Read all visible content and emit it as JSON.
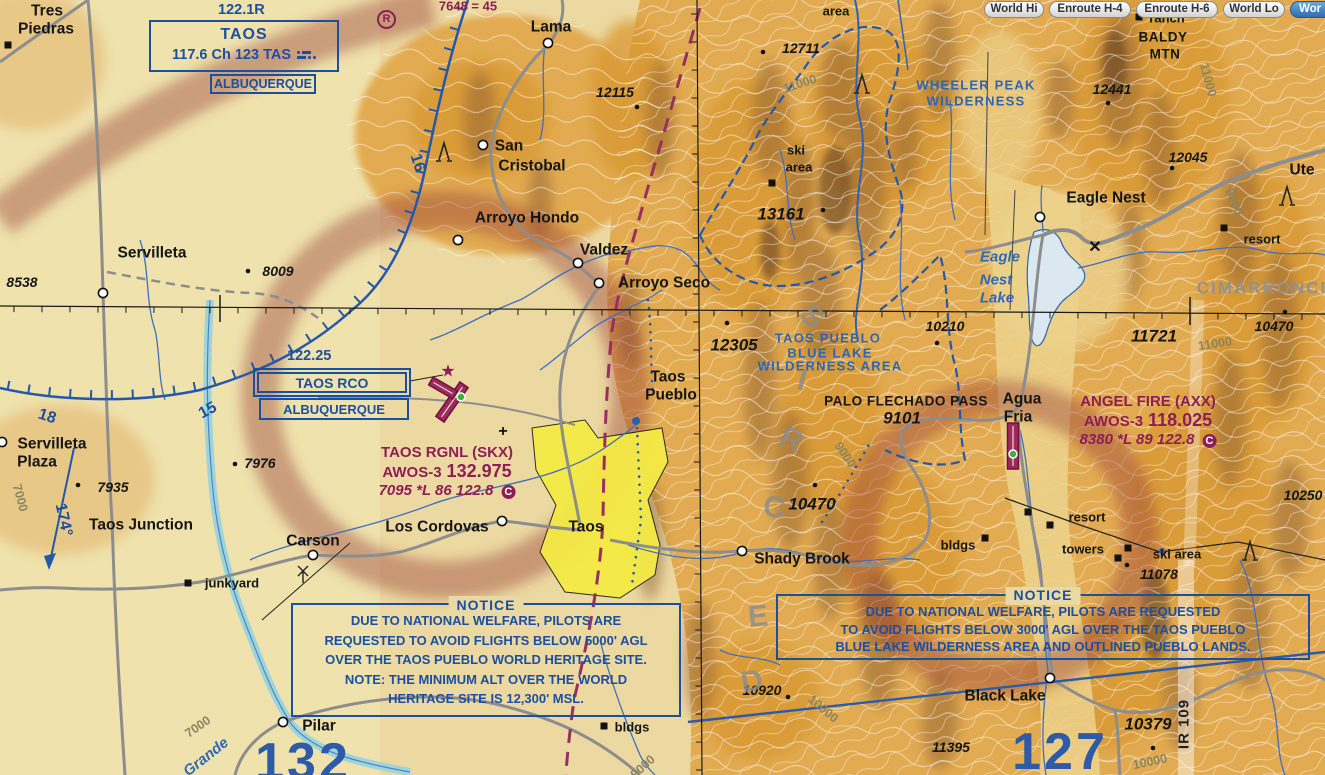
{
  "toolbar": {
    "buttons": [
      {
        "label": "World Hi",
        "active": false
      },
      {
        "label": "Enroute H-4",
        "active": false
      },
      {
        "label": "Enroute H-6",
        "active": false
      },
      {
        "label": "World Lo",
        "active": false
      },
      {
        "label": "Wor",
        "active": true
      }
    ]
  },
  "navaids": {
    "vor": {
      "freq": "122.1R",
      "name": "TAOS",
      "info": "117.6 Ch 123 TAS",
      "city": "ALBUQUERQUE"
    },
    "rco": {
      "freq": "122.25",
      "name": "TAOS RCO",
      "city": "ALBUQUERQUE"
    },
    "private_airport_symbol": "R"
  },
  "airports": {
    "taos_rgnl": {
      "name": "TAOS RGNL (SKX)",
      "awos": "AWOS-3",
      "freq": "132.975",
      "data": "7095 *L 86 122.8",
      "ctaf": "C"
    },
    "angel_fire": {
      "name": "ANGEL FIRE (AXX)",
      "awos": "AWOS-3",
      "freq": "118.025",
      "data": "8380 *L 89 122.8",
      "ctaf": "C"
    }
  },
  "notices": {
    "left": {
      "title": "NOTICE",
      "lines": [
        "DUE TO NATIONAL WELFARE, PILOTS ARE",
        "REQUESTED TO AVOID FLIGHTS BELOW 5000' AGL",
        "OVER THE TAOS PUEBLO WORLD HERITAGE SITE.",
        "NOTE: THE MINIMUM ALT OVER THE WORLD",
        "HERITAGE SITE IS 12,300' MSL."
      ]
    },
    "right": {
      "title": "NOTICE",
      "lines": [
        "DUE TO NATIONAL WELFARE, PILOTS ARE REQUESTED",
        "TO AVOID FLIGHTS BELOW 3000' AGL OVER THE TAOS PUEBLO",
        "BLUE LAKE WILDERNESS AREA AND OUTLINED PUEBLO LANDS."
      ]
    }
  },
  "colors": {
    "aero_blue": "#1d4fa0",
    "aero_magenta": "#8d1e55",
    "terrain_tan": "#ecd9a2",
    "terrain_orange": "#e2ab51",
    "city_yellow": "#f4ea45",
    "road_gray": "#8d8d8d",
    "water_blue": "#3f6fc0",
    "active_button_blue": "#2f6cb3"
  },
  "map": {
    "labels": [
      {
        "t": "Tres",
        "x": 47,
        "y": 11,
        "c": "town"
      },
      {
        "t": "Piedras",
        "x": 46,
        "y": 29,
        "c": "town"
      },
      {
        "t": "Lama",
        "x": 551,
        "y": 27,
        "c": "town"
      },
      {
        "t": "San",
        "x": 509,
        "y": 146,
        "c": "town"
      },
      {
        "t": "Cristobal",
        "x": 532,
        "y": 166,
        "c": "town"
      },
      {
        "t": "Arroyo Hondo",
        "x": 527,
        "y": 218,
        "c": "town"
      },
      {
        "t": "Valdez",
        "x": 604,
        "y": 250,
        "c": "town"
      },
      {
        "t": "Arroyo Seco",
        "x": 664,
        "y": 283,
        "c": "town"
      },
      {
        "t": "Servilleta",
        "x": 152,
        "y": 253,
        "c": "town"
      },
      {
        "t": "Servilleta",
        "x": 52,
        "y": 444,
        "c": "town"
      },
      {
        "t": "Plaza",
        "x": 37,
        "y": 462,
        "c": "town"
      },
      {
        "t": "Taos Junction",
        "x": 141,
        "y": 525,
        "c": "town"
      },
      {
        "t": "Carson",
        "x": 313,
        "y": 541,
        "c": "town"
      },
      {
        "t": "Los Cordovas",
        "x": 437,
        "y": 527,
        "c": "town"
      },
      {
        "t": "Taos",
        "x": 586,
        "y": 527,
        "c": "town"
      },
      {
        "t": "Shady Brook",
        "x": 802,
        "y": 559,
        "c": "town"
      },
      {
        "t": "Eagle Nest",
        "x": 1106,
        "y": 198,
        "c": "town"
      },
      {
        "t": "Black Lake",
        "x": 1005,
        "y": 696,
        "c": "town"
      },
      {
        "t": "Pilar",
        "x": 319,
        "y": 726,
        "c": "town"
      },
      {
        "t": "Agua",
        "x": 1022,
        "y": 399,
        "c": "town"
      },
      {
        "t": "Fria",
        "x": 1018,
        "y": 417,
        "c": "town"
      },
      {
        "t": "Taos",
        "x": 668,
        "y": 377,
        "c": "town"
      },
      {
        "t": "Pueblo",
        "x": 671,
        "y": 395,
        "c": "town"
      },
      {
        "t": "Ute",
        "x": 1302,
        "y": 170,
        "c": "town"
      },
      {
        "t": "ranch",
        "x": 1167,
        "y": 18,
        "c": "town-sm"
      },
      {
        "t": "junkyard",
        "x": 232,
        "y": 583,
        "c": "town-sm"
      },
      {
        "t": "bldgs",
        "x": 632,
        "y": 727,
        "c": "town-sm"
      },
      {
        "t": "bldgs",
        "x": 958,
        "y": 545,
        "c": "town-sm"
      },
      {
        "t": "resort",
        "x": 1087,
        "y": 517,
        "c": "town-sm"
      },
      {
        "t": "towers",
        "x": 1083,
        "y": 549,
        "c": "town-sm"
      },
      {
        "t": "ski area",
        "x": 1177,
        "y": 554,
        "c": "town-sm"
      },
      {
        "t": "resort",
        "x": 1262,
        "y": 239,
        "c": "town-sm"
      },
      {
        "t": "ski",
        "x": 796,
        "y": 150,
        "c": "town-sm"
      },
      {
        "t": "area",
        "x": 799,
        "y": 167,
        "c": "town-sm"
      },
      {
        "t": "area",
        "x": 836,
        "y": 11,
        "c": "town-sm"
      },
      {
        "t": "BALDY",
        "x": 1163,
        "y": 37,
        "c": "town-caps"
      },
      {
        "t": "MTN",
        "x": 1165,
        "y": 54,
        "c": "town-caps"
      },
      {
        "t": "PALO FLECHADO PASS",
        "x": 906,
        "y": 401,
        "c": "town-caps"
      },
      {
        "t": "8538",
        "x": 22,
        "y": 282,
        "c": "elev"
      },
      {
        "t": "8009",
        "x": 278,
        "y": 271,
        "c": "elev"
      },
      {
        "t": "7976",
        "x": 260,
        "y": 463,
        "c": "elev"
      },
      {
        "t": "7935",
        "x": 113,
        "y": 487,
        "c": "elev"
      },
      {
        "t": "12115",
        "x": 615,
        "y": 92,
        "c": "elev"
      },
      {
        "t": "12711",
        "x": 801,
        "y": 48,
        "c": "elev"
      },
      {
        "t": "12441",
        "x": 1112,
        "y": 89,
        "c": "elev"
      },
      {
        "t": "12045",
        "x": 1188,
        "y": 157,
        "c": "elev"
      },
      {
        "t": "13161",
        "x": 781,
        "y": 214,
        "c": "elev-lg"
      },
      {
        "t": "12305",
        "x": 734,
        "y": 345,
        "c": "elev-lg"
      },
      {
        "t": "10210",
        "x": 945,
        "y": 326,
        "c": "elev"
      },
      {
        "t": "11721",
        "x": 1154,
        "y": 336,
        "c": "elev-lg"
      },
      {
        "t": "10470",
        "x": 1274,
        "y": 326,
        "c": "elev"
      },
      {
        "t": "10470",
        "x": 812,
        "y": 504,
        "c": "elev-lg"
      },
      {
        "t": "9101",
        "x": 902,
        "y": 418,
        "c": "elev-lg"
      },
      {
        "t": "11078",
        "x": 1159,
        "y": 574,
        "c": "elev"
      },
      {
        "t": "10250",
        "x": 1303,
        "y": 495,
        "c": "elev"
      },
      {
        "t": "10920",
        "x": 762,
        "y": 690,
        "c": "elev"
      },
      {
        "t": "11395",
        "x": 951,
        "y": 747,
        "c": "elev"
      },
      {
        "t": "10379",
        "x": 1148,
        "y": 724,
        "c": "elev-lg"
      },
      {
        "t": "WHEELER PEAK",
        "x": 976,
        "y": 85,
        "c": "wild"
      },
      {
        "t": "WILDERNESS",
        "x": 976,
        "y": 101,
        "c": "wild"
      },
      {
        "t": "TAOS PUEBLO",
        "x": 828,
        "y": 338,
        "c": "wild"
      },
      {
        "t": "BLUE LAKE",
        "x": 830,
        "y": 353,
        "c": "wild"
      },
      {
        "t": "WILDERNESS AREA",
        "x": 830,
        "y": 366,
        "c": "wild"
      },
      {
        "t": "Eagle",
        "x": 1000,
        "y": 257,
        "c": "blue-it"
      },
      {
        "t": "Nest",
        "x": 996,
        "y": 280,
        "c": "blue-it"
      },
      {
        "t": "Lake",
        "x": 997,
        "y": 298,
        "c": "blue-it"
      },
      {
        "t": "CIMARRONCI",
        "x": 1262,
        "y": 288,
        "c": "gray-caps"
      },
      {
        "t": "Grande",
        "x": 206,
        "y": 757,
        "c": "river",
        "r": -38
      },
      {
        "t": "11000",
        "x": 800,
        "y": 84,
        "c": "contour",
        "r": -18
      },
      {
        "t": "11000",
        "x": 1208,
        "y": 80,
        "c": "contour",
        "r": 75
      },
      {
        "t": "11000",
        "x": 1215,
        "y": 344,
        "c": "contour",
        "r": -8
      },
      {
        "t": "8000",
        "x": 1234,
        "y": 202,
        "c": "contour",
        "r": 68
      },
      {
        "t": "9000",
        "x": 845,
        "y": 455,
        "c": "contour",
        "r": 55
      },
      {
        "t": "10000",
        "x": 823,
        "y": 709,
        "c": "contour",
        "r": 40
      },
      {
        "t": "10000",
        "x": 1150,
        "y": 762,
        "c": "contour",
        "r": -12
      },
      {
        "t": "7000",
        "x": 20,
        "y": 498,
        "c": "contour",
        "r": 75
      },
      {
        "t": "7000",
        "x": 198,
        "y": 727,
        "c": "contour",
        "r": -35
      },
      {
        "t": "9000",
        "x": 643,
        "y": 767,
        "c": "contour",
        "r": -42
      },
      {
        "t": "18",
        "x": 47,
        "y": 417,
        "c": "rose",
        "r": 18
      },
      {
        "t": "15",
        "x": 208,
        "y": 411,
        "c": "rose",
        "r": -28
      },
      {
        "t": "16",
        "x": 417,
        "y": 163,
        "c": "rose",
        "r": 72
      },
      {
        "t": "174°",
        "x": 63,
        "y": 520,
        "c": "rose",
        "r": 78
      },
      {
        "t": "127",
        "x": 1060,
        "y": 752,
        "c": "mef"
      },
      {
        "t": "132",
        "x": 303,
        "y": 762,
        "c": "mef"
      },
      {
        "t": "IR 109",
        "x": 1184,
        "y": 724,
        "c": "mtr",
        "r": -90
      },
      {
        "t": "S",
        "x": 812,
        "y": 317,
        "c": "mtn",
        "r": 40
      },
      {
        "t": "I",
        "x": 802,
        "y": 381,
        "c": "mtn",
        "r": 15
      },
      {
        "t": "R",
        "x": 791,
        "y": 440,
        "c": "mtn",
        "r": 25
      },
      {
        "t": "C",
        "x": 774,
        "y": 508,
        "c": "mtn",
        "r": 10
      },
      {
        "t": "E",
        "x": 758,
        "y": 617,
        "c": "mtn",
        "r": -5
      },
      {
        "t": "D",
        "x": 752,
        "y": 682,
        "c": "mtn",
        "r": -10
      },
      {
        "t": "7648 = 45",
        "x": 468,
        "y": 6,
        "c": "obst-mag"
      },
      {
        "t": "★",
        "x": 448,
        "y": 371,
        "c": "star"
      },
      {
        "t": "+",
        "x": 503,
        "y": 432,
        "c": "plus"
      },
      {
        "t": "✕",
        "x": 1095,
        "y": 248,
        "c": "plus"
      }
    ],
    "icons": [
      {
        "k": "circle",
        "x": 548,
        "y": 43
      },
      {
        "k": "circle",
        "x": 483,
        "y": 145
      },
      {
        "k": "circle",
        "x": 458,
        "y": 240
      },
      {
        "k": "circle",
        "x": 578,
        "y": 263
      },
      {
        "k": "circle",
        "x": 599,
        "y": 283
      },
      {
        "k": "circle",
        "x": 103,
        "y": 293
      },
      {
        "k": "circle",
        "x": 2,
        "y": 442
      },
      {
        "k": "circle",
        "x": 283,
        "y": 722
      },
      {
        "k": "circle",
        "x": 313,
        "y": 555
      },
      {
        "k": "circle",
        "x": 502,
        "y": 521
      },
      {
        "k": "circle",
        "x": 742,
        "y": 551
      },
      {
        "k": "circle",
        "x": 1040,
        "y": 217
      },
      {
        "k": "circle",
        "x": 1050,
        "y": 678
      },
      {
        "k": "square",
        "x": 8,
        "y": 45
      },
      {
        "k": "square",
        "x": 188,
        "y": 583
      },
      {
        "k": "square",
        "x": 604,
        "y": 726
      },
      {
        "k": "square",
        "x": 985,
        "y": 538
      },
      {
        "k": "square",
        "x": 1028,
        "y": 512
      },
      {
        "k": "square",
        "x": 1050,
        "y": 525
      },
      {
        "k": "square",
        "x": 1118,
        "y": 558
      },
      {
        "k": "square",
        "x": 1128,
        "y": 548
      },
      {
        "k": "square",
        "x": 772,
        "y": 183
      },
      {
        "k": "square",
        "x": 1224,
        "y": 228
      },
      {
        "k": "square",
        "x": 1139,
        "y": 17
      },
      {
        "k": "dot",
        "x": 637,
        "y": 107
      },
      {
        "k": "dot",
        "x": 763,
        "y": 52
      },
      {
        "k": "dot",
        "x": 823,
        "y": 210
      },
      {
        "k": "dot",
        "x": 727,
        "y": 323
      },
      {
        "k": "dot",
        "x": 937,
        "y": 343
      },
      {
        "k": "dot",
        "x": 1285,
        "y": 312
      },
      {
        "k": "dot",
        "x": 248,
        "y": 271
      },
      {
        "k": "dot",
        "x": 235,
        "y": 464
      },
      {
        "k": "dot",
        "x": 78,
        "y": 485
      },
      {
        "k": "dot",
        "x": 1127,
        "y": 565
      },
      {
        "k": "dot",
        "x": 788,
        "y": 697
      },
      {
        "k": "dot",
        "x": 1153,
        "y": 748
      },
      {
        "k": "dot",
        "x": 1108,
        "y": 103
      },
      {
        "k": "dot",
        "x": 1172,
        "y": 168
      },
      {
        "k": "dot",
        "x": 815,
        "y": 485
      },
      {
        "k": "bluedot",
        "x": 636,
        "y": 421,
        "r": 4
      },
      {
        "k": "bluedot",
        "x": 1162,
        "y": 551,
        "r": 3
      },
      {
        "k": "obstacle",
        "x": 444,
        "y": 152
      },
      {
        "k": "obstacle",
        "x": 862,
        "y": 84
      },
      {
        "k": "obstacle",
        "x": 1250,
        "y": 551
      },
      {
        "k": "obstacle",
        "x": 1287,
        "y": 196
      },
      {
        "k": "wind",
        "x": 303,
        "y": 574
      },
      {
        "k": "runway",
        "x": 452,
        "y": 402,
        "rot": 35,
        "len": 42,
        "w": 10
      },
      {
        "k": "runway",
        "x": 443,
        "y": 388,
        "rot": 120,
        "len": 28,
        "w": 9
      },
      {
        "k": "runway",
        "x": 1013,
        "y": 446,
        "rot": 0,
        "len": 46,
        "w": 11
      },
      {
        "k": "beacon",
        "x": 461,
        "y": 397
      },
      {
        "k": "beacon",
        "x": 1013,
        "y": 454
      }
    ]
  }
}
